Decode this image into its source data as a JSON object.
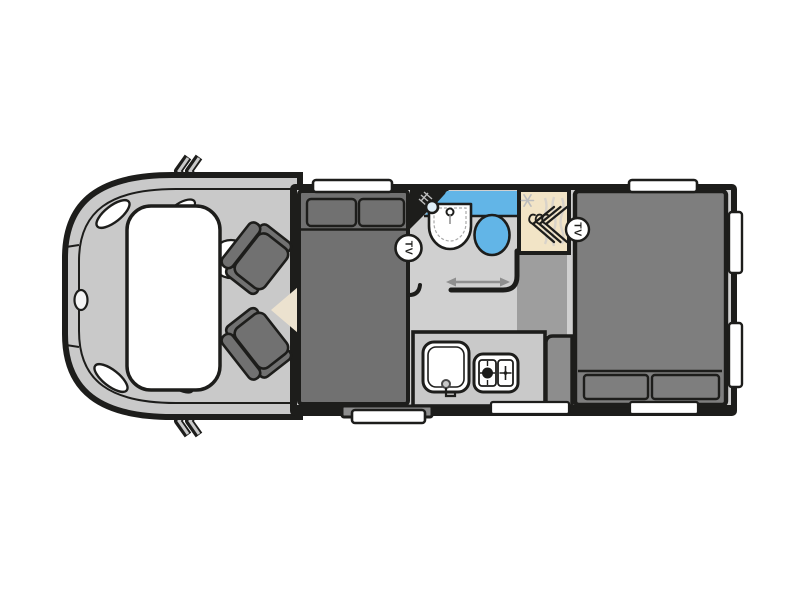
{
  "diagram": {
    "name": "motorhome-floorplan",
    "badges": {
      "tv_front": "TV",
      "tv_rear": "TV"
    },
    "icons": {
      "wing_mirror": "folded wing mirror zigzag",
      "steering_wheel": "steering wheel circle",
      "headlight": "headlight highlight",
      "vehicle_badge": "front grille badge",
      "shower_head": "shower head with spray",
      "washbasin": "half-round basin with tap",
      "toilet": "round toilet bowl",
      "wardrobe_hangers": "three coat hangers",
      "snowflake": "frost symbol",
      "sliding_door_arrow": "double-headed slide arrow",
      "kitchen_sink": "rounded sink with tap",
      "hob": "two-burner hob",
      "entry_step": "fold-out entry step",
      "tv_badge": "circled TV label"
    },
    "colors": {
      "outline": "#1d1d1b",
      "background": "#ffffff",
      "white": "#ffffff",
      "cab_body": "#c9c9c9",
      "floor_light": "#d0d0d0",
      "floor_medium": "#9e9e9e",
      "furniture_dark": "#717171",
      "furniture_rear": "#7e7e7e",
      "cabinet_gray": "#8d8d8d",
      "counter_gray": "#c9c9c9",
      "water_blue": "#62b5e7",
      "wardrobe_beige": "#f2e4c6",
      "table_cream": "#ece2cf",
      "arrow_gray": "#8f8f8f"
    }
  }
}
